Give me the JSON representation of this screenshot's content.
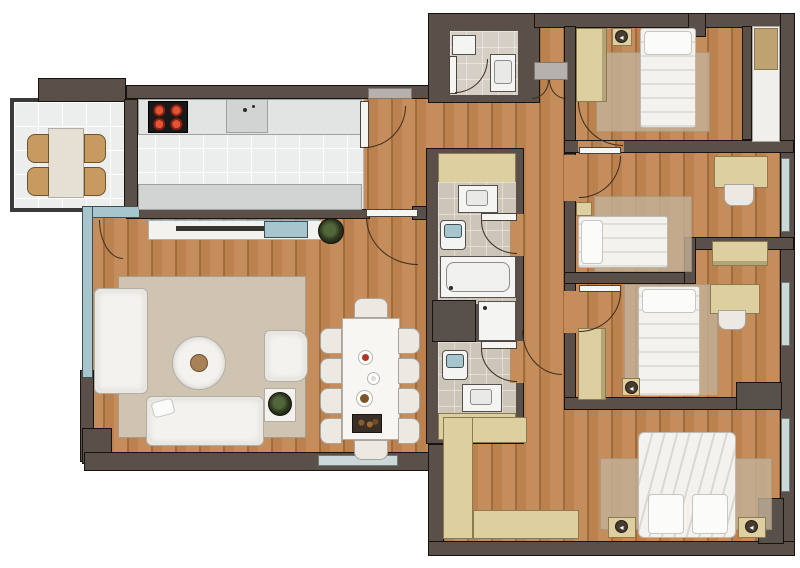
{
  "title": "apartment-floor-plan",
  "palette": {
    "wall": "#5a5049",
    "wall2": "#6a6058",
    "wallEdge": "#171310",
    "wood": "#c48d5b",
    "wood2": "#bb8250",
    "woodDark": "#a06c3e",
    "tileKitchen": "#eceeed",
    "tileBath": "#cdc5b8",
    "whiteFloor": "#f0efec",
    "rug": "#cfc4b1",
    "rugBed": "#c3b29a",
    "white": "#f3f2ee",
    "whiteEdge": "#b2aea6",
    "tan": "#ddcf9f",
    "tan2": "#bfa271",
    "tanDark": "#8a7b50",
    "blue": "#a6c5cd",
    "blueSoft": "#ccd8d7",
    "counter": "#e2e4e4",
    "counter2": "#d2d4d4",
    "gray": "#b5b1ad",
    "shaft": "#57504b"
  },
  "icons": {
    "lamp": "◂"
  },
  "rooms": {
    "balcony": {
      "furniture": [
        "dining-table",
        "chair x4"
      ]
    },
    "kitchen": {
      "furniture": [
        "counter-top",
        "stove-4-burners",
        "sink",
        "counter-bottom",
        "door"
      ]
    },
    "living_room": {
      "furniture": [
        "tv-console",
        "tv",
        "sofa-3seat",
        "sofa-chaise",
        "armchair",
        "round-coffee-table",
        "side-table",
        "plant x2",
        "dining-table-10-chairs",
        "rug",
        "window",
        "glass-wall",
        "balcony-door"
      ]
    },
    "entry_hall": {
      "furniture": [
        "double-entry-door",
        "threshold"
      ]
    },
    "wc": {
      "furniture": [
        "sink",
        "toilet",
        "door"
      ]
    },
    "bathroom_1": {
      "furniture": [
        "cabinet",
        "sink",
        "toilet",
        "bathtub",
        "door"
      ]
    },
    "bathroom_2": {
      "furniture": [
        "toilet",
        "sink",
        "cabinet",
        "door"
      ]
    },
    "utility": {
      "furniture": [
        "shaft",
        "shower"
      ]
    },
    "bedroom_1": {
      "furniture": [
        "single-bed",
        "nightstand-lamp",
        "wardrobe",
        "rug",
        "bay-cabinet",
        "door"
      ]
    },
    "bedroom_2": {
      "furniture": [
        "single-bed",
        "nightstand-lamp",
        "desk",
        "chair",
        "wardrobe",
        "rug",
        "window",
        "door"
      ]
    },
    "bedroom_3": {
      "furniture": [
        "single-bed",
        "nightstand-lamp",
        "desk",
        "chair",
        "wardrobe",
        "rug",
        "window",
        "door"
      ]
    },
    "master_bedroom": {
      "furniture": [
        "double-bed",
        "nightstand-lamp x2",
        "l-shaped-wardrobe",
        "rug",
        "window",
        "door"
      ]
    }
  }
}
